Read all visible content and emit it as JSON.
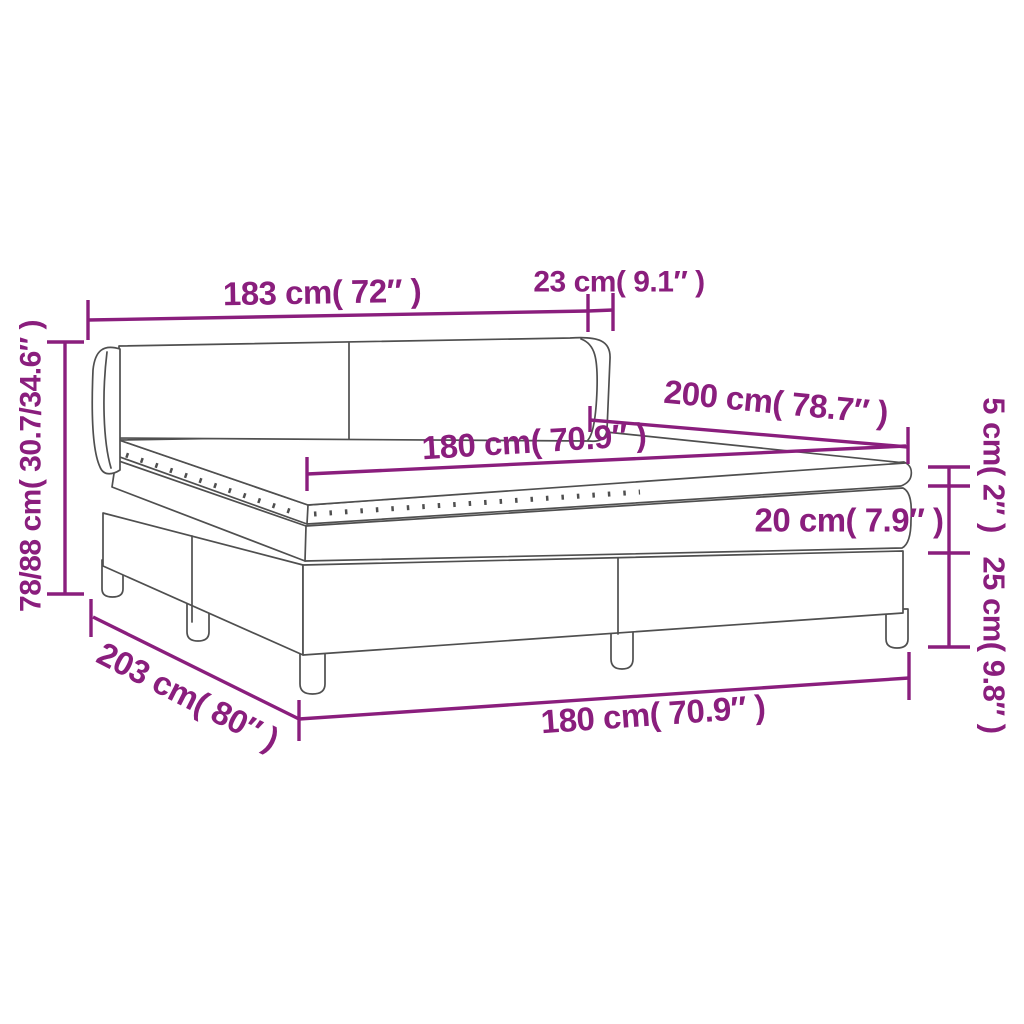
{
  "diagram": {
    "type": "product-dimension-diagram",
    "subject": "box spring bed with headboard, mattress and topper",
    "background_color": "#ffffff",
    "accent_color": "#8a1e7d",
    "outline_color": "#4f4f4f",
    "labels": {
      "headboard_width": "183 cm( 72″ )",
      "headboard_depth": "23 cm( 9.1″ )",
      "bed_length": "200 cm( 78.7″ )",
      "mattress_width": "180 cm( 70.9″ )",
      "topper_height": "5 cm( 2″ )",
      "mattress_height": "20 cm( 7.9″ )",
      "base_height": "25 cm( 9.8″ )",
      "total_height": "78/88 cm( 30.7/34.6″ )",
      "base_length": "203 cm( 80″ )",
      "base_width": "180 cm( 70.9″ )"
    }
  }
}
